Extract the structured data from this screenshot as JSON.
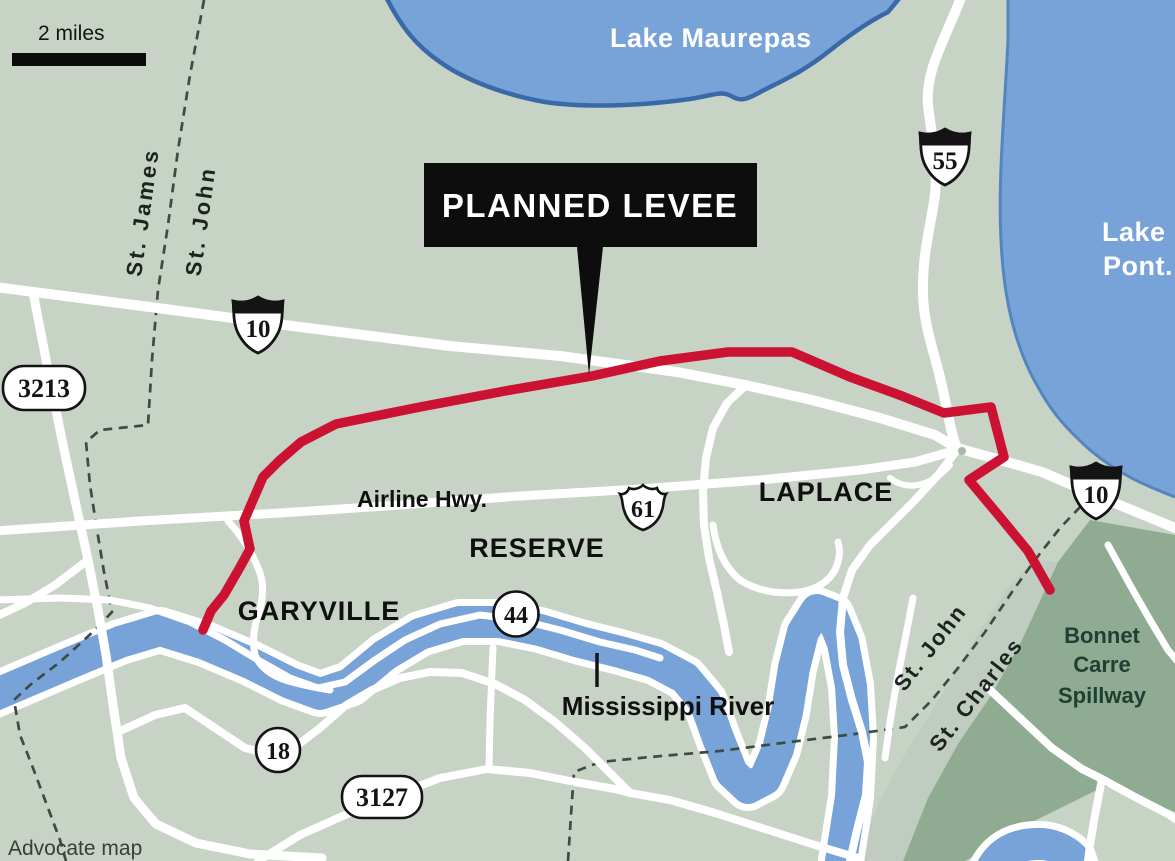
{
  "map": {
    "scale": {
      "label": "2 miles"
    },
    "credit": "Advocate map",
    "callout": {
      "label": "PLANNED LEVEE"
    },
    "water": {
      "lake_maurepas": "Lake Maurepas",
      "lake_pont_line1": "Lake",
      "lake_pont_line2": "Pont.",
      "river": "Mississippi River"
    },
    "towns": {
      "garyville": "GARYVILLE",
      "reserve": "RESERVE",
      "laplace": "LAPLACE"
    },
    "streets": {
      "airline_hwy": "Airline Hwy."
    },
    "shields": {
      "interstate_10_west": "10",
      "interstate_10_east": "10",
      "interstate_55": "55",
      "us_61": "61",
      "la_44": "44",
      "la_18": "18",
      "la_3213": "3213",
      "la_3127": "3127"
    },
    "parish_boundaries": {
      "st_james": "St. James",
      "st_john_upper": "St. John",
      "st_john_lower": "St. John",
      "st_charles": "St. Charles"
    },
    "areas": {
      "spillway_line1": "Bonnet",
      "spillway_line2": "Carre",
      "spillway_line3": "Spillway"
    },
    "colors": {
      "land": "#c7d3c5",
      "water": "#78a3d8",
      "water_edge": "#3a69a8",
      "road": "#ffffff",
      "levee": "#cb1233",
      "spillway": "#8fab92",
      "parish_strip": "#bfcabf",
      "callout_bg": "#0d0d0d",
      "boundary": "#3e4b44",
      "spillway_ink": "#1d4033"
    }
  }
}
